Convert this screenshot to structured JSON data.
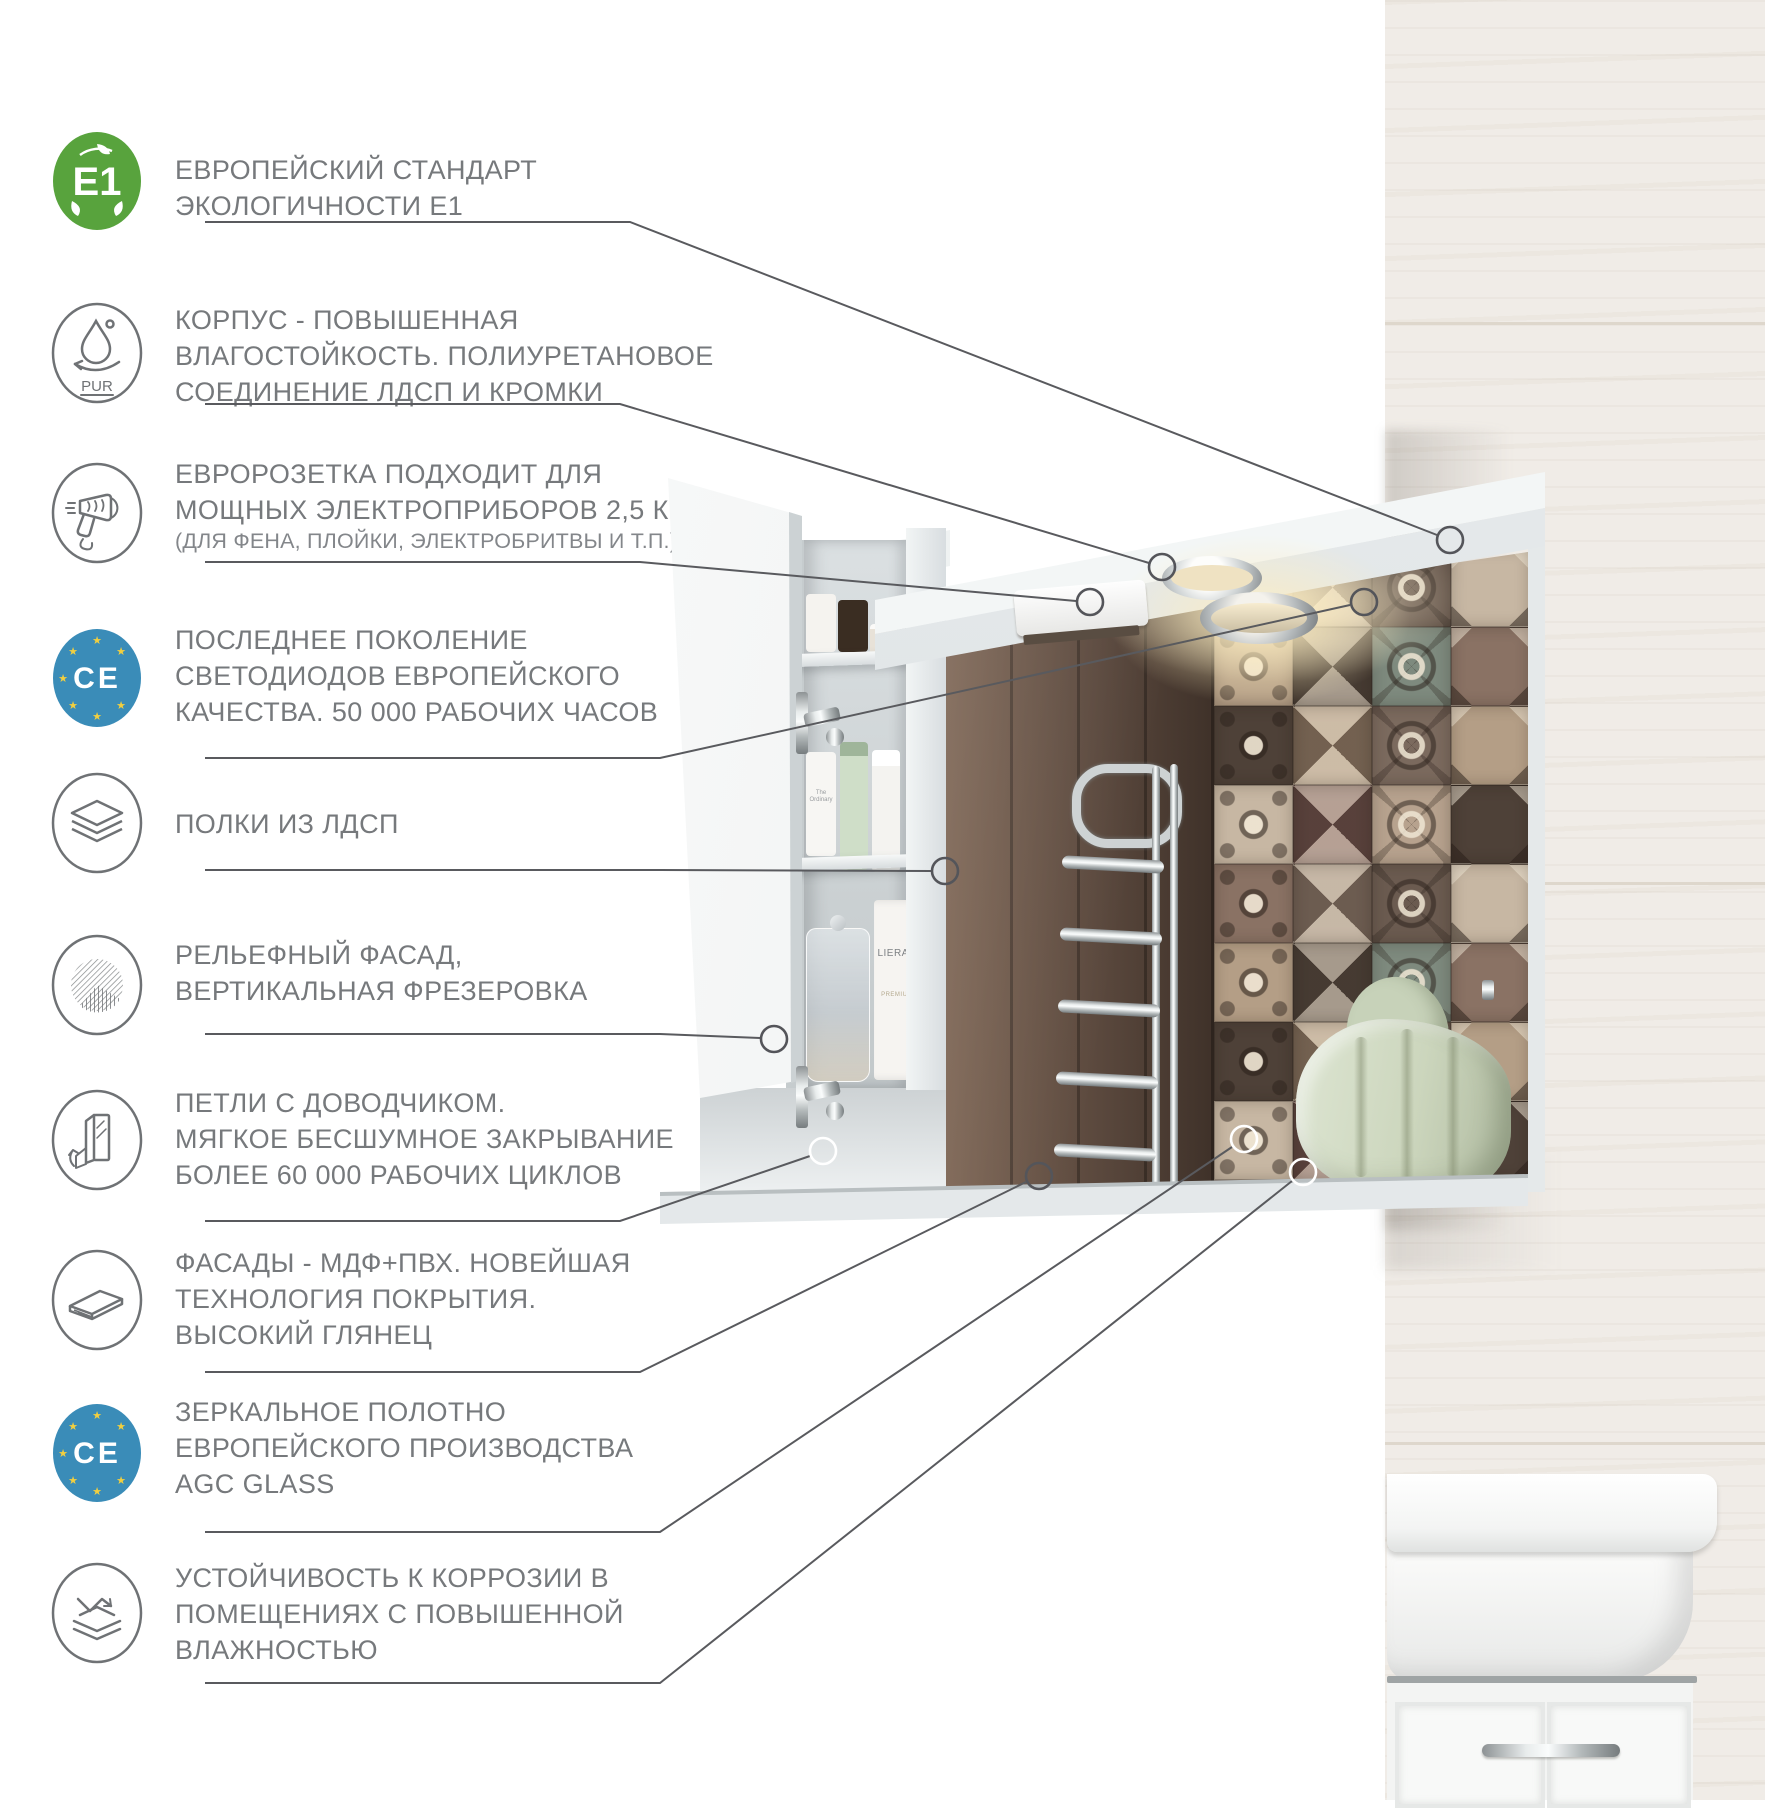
{
  "colors": {
    "text": "#76797c",
    "line": "#595a5e",
    "e1_green": "#58a33d",
    "ce_blue": "#3a8cb8",
    "star_yellow": "#f2cf3f",
    "icon_stroke": "#6f7275"
  },
  "features": [
    {
      "icon": "e1-eco-icon",
      "icon_label": "E1",
      "text": "ЕВРОПЕЙСКИЙ СТАНДАРТ\nЭКОЛОГИЧНОСТИ Е1"
    },
    {
      "icon": "pur-moisture-icon",
      "icon_label": "PUR",
      "text": "КОРПУС - ПОВЫШЕННАЯ\nВЛАГОСТОЙКОСТЬ. ПОЛИУРЕТАНОВОЕ\nСОЕДИНЕНИЕ ЛДСП И КРОМКИ"
    },
    {
      "icon": "hairdryer-icon",
      "text": "ЕВРОРОЗЕТКА ПОДХОДИТ ДЛЯ\nМОЩНЫХ ЭЛЕКТРОПРИБОРОВ 2,5 КВТ",
      "note": "(ДЛЯ ФЕНА, ПЛОЙКИ, ЭЛЕКТРОБРИТВЫ И Т.П.)"
    },
    {
      "icon": "ce-mark-icon",
      "icon_label": "CE",
      "text": "ПОСЛЕДНЕЕ ПОКОЛЕНИЕ\nСВЕТОДИОДОВ ЕВРОПЕЙСКОГО\nКАЧЕСТВА. 50 000 РАБОЧИХ ЧАСОВ"
    },
    {
      "icon": "layers-icon",
      "text": "ПОЛКИ ИЗ ЛДСП"
    },
    {
      "icon": "texture-icon",
      "text": "РЕЛЬЕФНЫЙ ФАСАД,\nВЕРТИКАЛЬНАЯ ФРЕЗЕРОВКА"
    },
    {
      "icon": "soft-close-door-icon",
      "text": "ПЕТЛИ С ДОВОДЧИКОМ.\nМЯГКОЕ БЕСШУМНОЕ ЗАКРЫВАНИЕ\nБОЛЕЕ 60 000 РАБОЧИХ ЦИКЛОВ"
    },
    {
      "icon": "glossy-panel-icon",
      "text": "ФАСАДЫ -  МДФ+ПВХ. НОВЕЙШАЯ\nТЕХНОЛОГИЯ ПОКРЫТИЯ.\nВЫСОКИЙ ГЛЯНЕЦ"
    },
    {
      "icon": "ce-mark-icon",
      "icon_label": "CE",
      "text": "ЗЕРКАЛЬНОЕ  ПОЛОТНО\nЕВРОПЕЙСКОГО ПРОИЗВОДСТВА\nAGC GLASS"
    },
    {
      "icon": "corrosion-resist-icon",
      "text": "УСТОЙЧИВОСТЬ К КОРРОЗИИ В\nПОМЕЩЕНИЯХ С ПОВЫШЕННОЙ\nВЛАЖНОСТЬЮ"
    }
  ],
  "photo": {
    "products": {
      "tube_brand": "LIERAC",
      "tube_line": "PREMIUM",
      "small_tube": "The Ordinary"
    },
    "tile_palette": [
      "#8a7264",
      "#b7a28e",
      "#5c4f45",
      "#c7b7a3",
      "#7b6a5e",
      "#9c8878",
      "#4e4138",
      "#7e8a7e",
      "#7a5a55",
      "#b49e86",
      "#6b5b50",
      "#a89078"
    ]
  }
}
